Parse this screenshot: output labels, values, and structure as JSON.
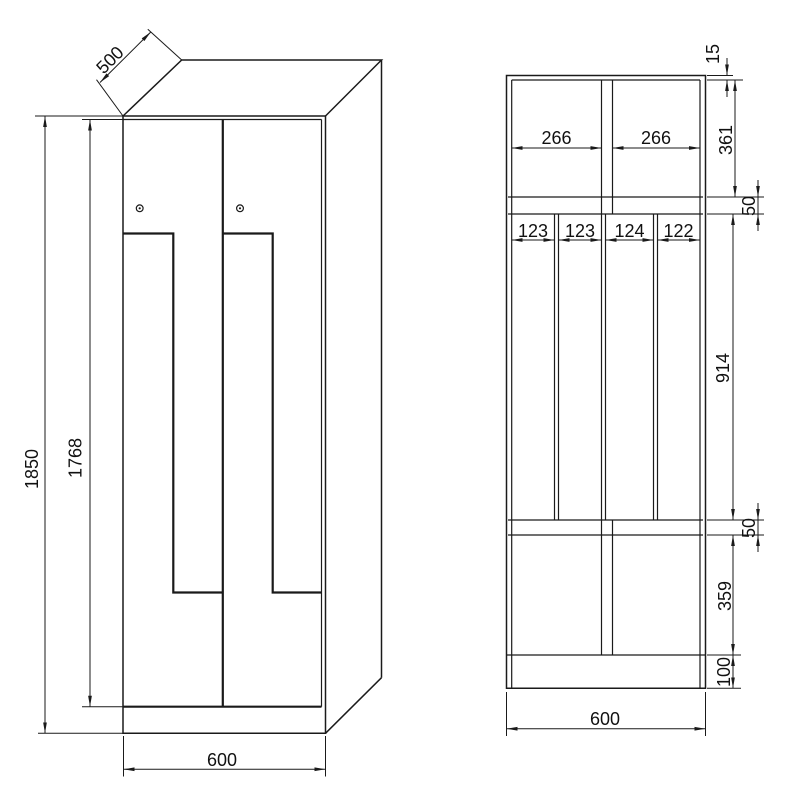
{
  "colors": {
    "line": "#1a1a1a",
    "background": "#ffffff"
  },
  "perspective_view": {
    "depth_mm": "500",
    "height_mm": "1850",
    "door_height_mm": "1768",
    "width_mm": "600"
  },
  "section_view": {
    "top_panel_mm": "15",
    "top_compartment_mm": "361",
    "upper_shelf_mm": "50",
    "middle_compartment_mm": "914",
    "lower_shelf_mm": "50",
    "bottom_compartment_mm": "359",
    "plinth_mm": "100",
    "upper_left_width_mm": "266",
    "upper_right_width_mm": "266",
    "slot_widths_mm": [
      "123",
      "123",
      "124",
      "122"
    ],
    "overall_width_mm": "600"
  }
}
